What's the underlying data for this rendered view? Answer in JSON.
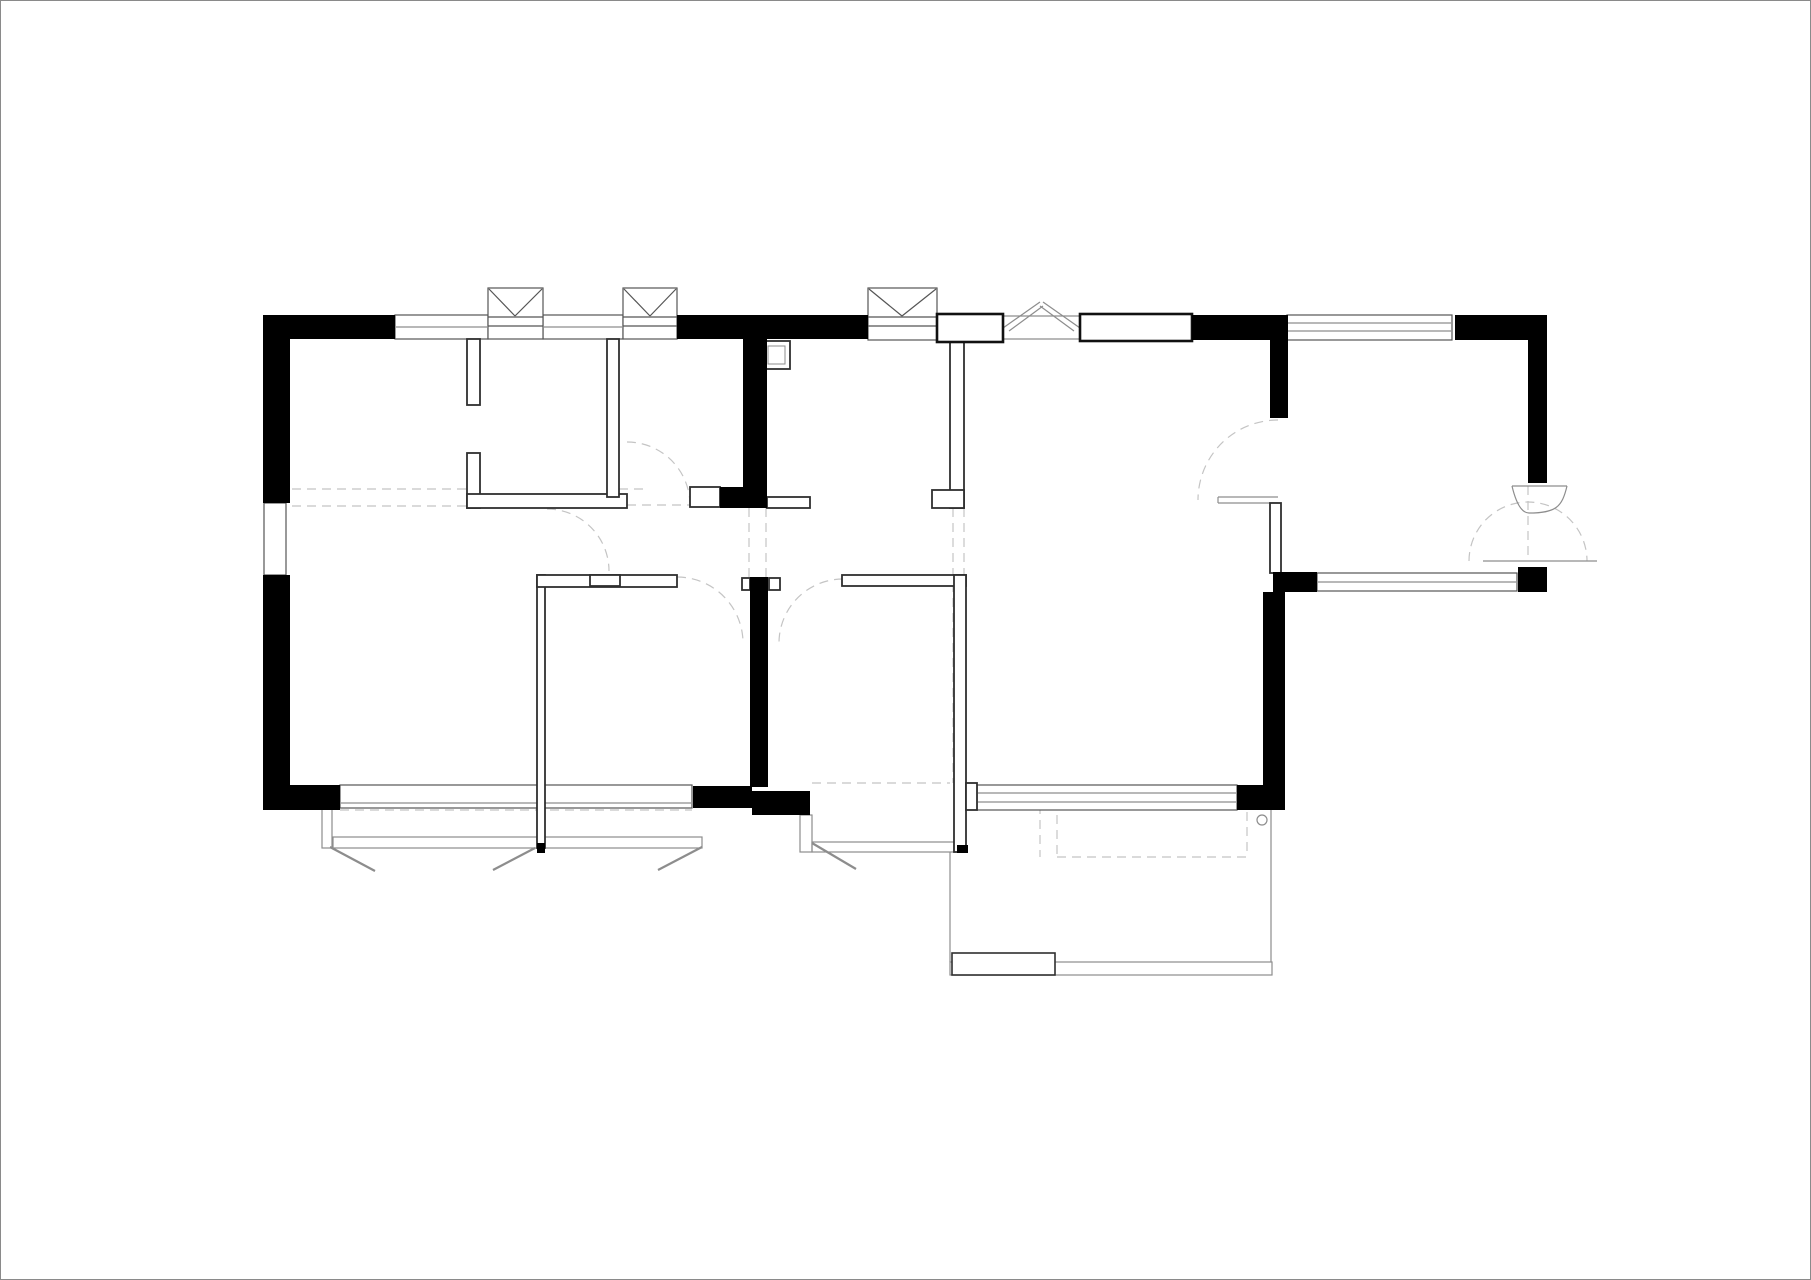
{
  "drawing": {
    "kind": "apartment floor plan, line drawing, no annotations"
  },
  "colors": {
    "background": "#ffffff",
    "wall_fill": "#000000",
    "partition_stroke": "#2f2f2f",
    "window_stroke": "#555555",
    "bold_opening_stroke": "#111111",
    "light_stroke": "#8d8d8d",
    "dashed_stroke": "#c4c4c4",
    "page_border": "#8a8a8a"
  },
  "symbols": {
    "x_window": "window box with X mullion mark",
    "plain_window": "double-line window band",
    "cased_opening": "bold outlined wall opening",
    "chevron_opening": "double-stroke chevron above wall",
    "door_swing": "dashed quarter-circle swing arc",
    "pivot_door": "fan leaf with dashed semicircle swing",
    "balcony_tick": "diagonal open-casement mark",
    "shaft": "small double-lined duct square",
    "beam_line": "dashed overhead beam line"
  }
}
